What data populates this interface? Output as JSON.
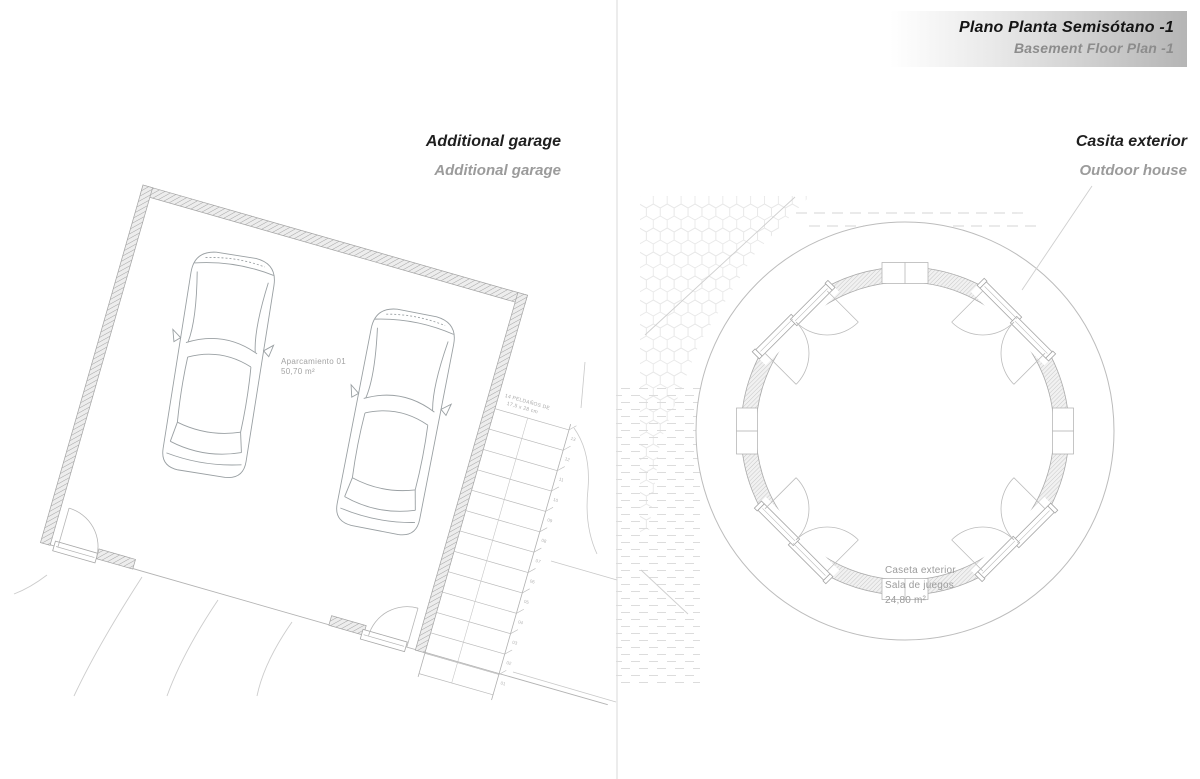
{
  "header": {
    "title_es": "Plano Planta Semisótano -1",
    "title_en": "Basement Floor Plan -1"
  },
  "panels": {
    "garage": {
      "title_primary": "Additional garage",
      "title_secondary": "Additional garage",
      "room_label": {
        "name": "Aparcamiento 01",
        "area": "50,70 m²"
      },
      "stairs": {
        "note_line1": "14 PELDAÑOS DE",
        "note_line2": "17,5 x 28 cm",
        "step_numbers": [
          "13",
          "12",
          "11",
          "10",
          "09",
          "08",
          "07",
          "06",
          "05",
          "04",
          "03",
          "02",
          "01"
        ]
      }
    },
    "outdoor_house": {
      "title_primary": "Casita exterior",
      "title_secondary": "Outdoor house",
      "room_label": {
        "name": "Caseta exterior",
        "use": "Sala de juegos",
        "area": "24,80 m²"
      }
    }
  },
  "colors": {
    "header_gradient_end": "#b5b5b5",
    "header_text": "#141414",
    "header_subtext": "#8c8c8c",
    "title_text": "#1f1f1f",
    "title_subtext": "#9b9b9b",
    "plan_lines": "#a8a8a8",
    "plan_faint": "#cccccc",
    "label_text": "#9c9c9c"
  }
}
